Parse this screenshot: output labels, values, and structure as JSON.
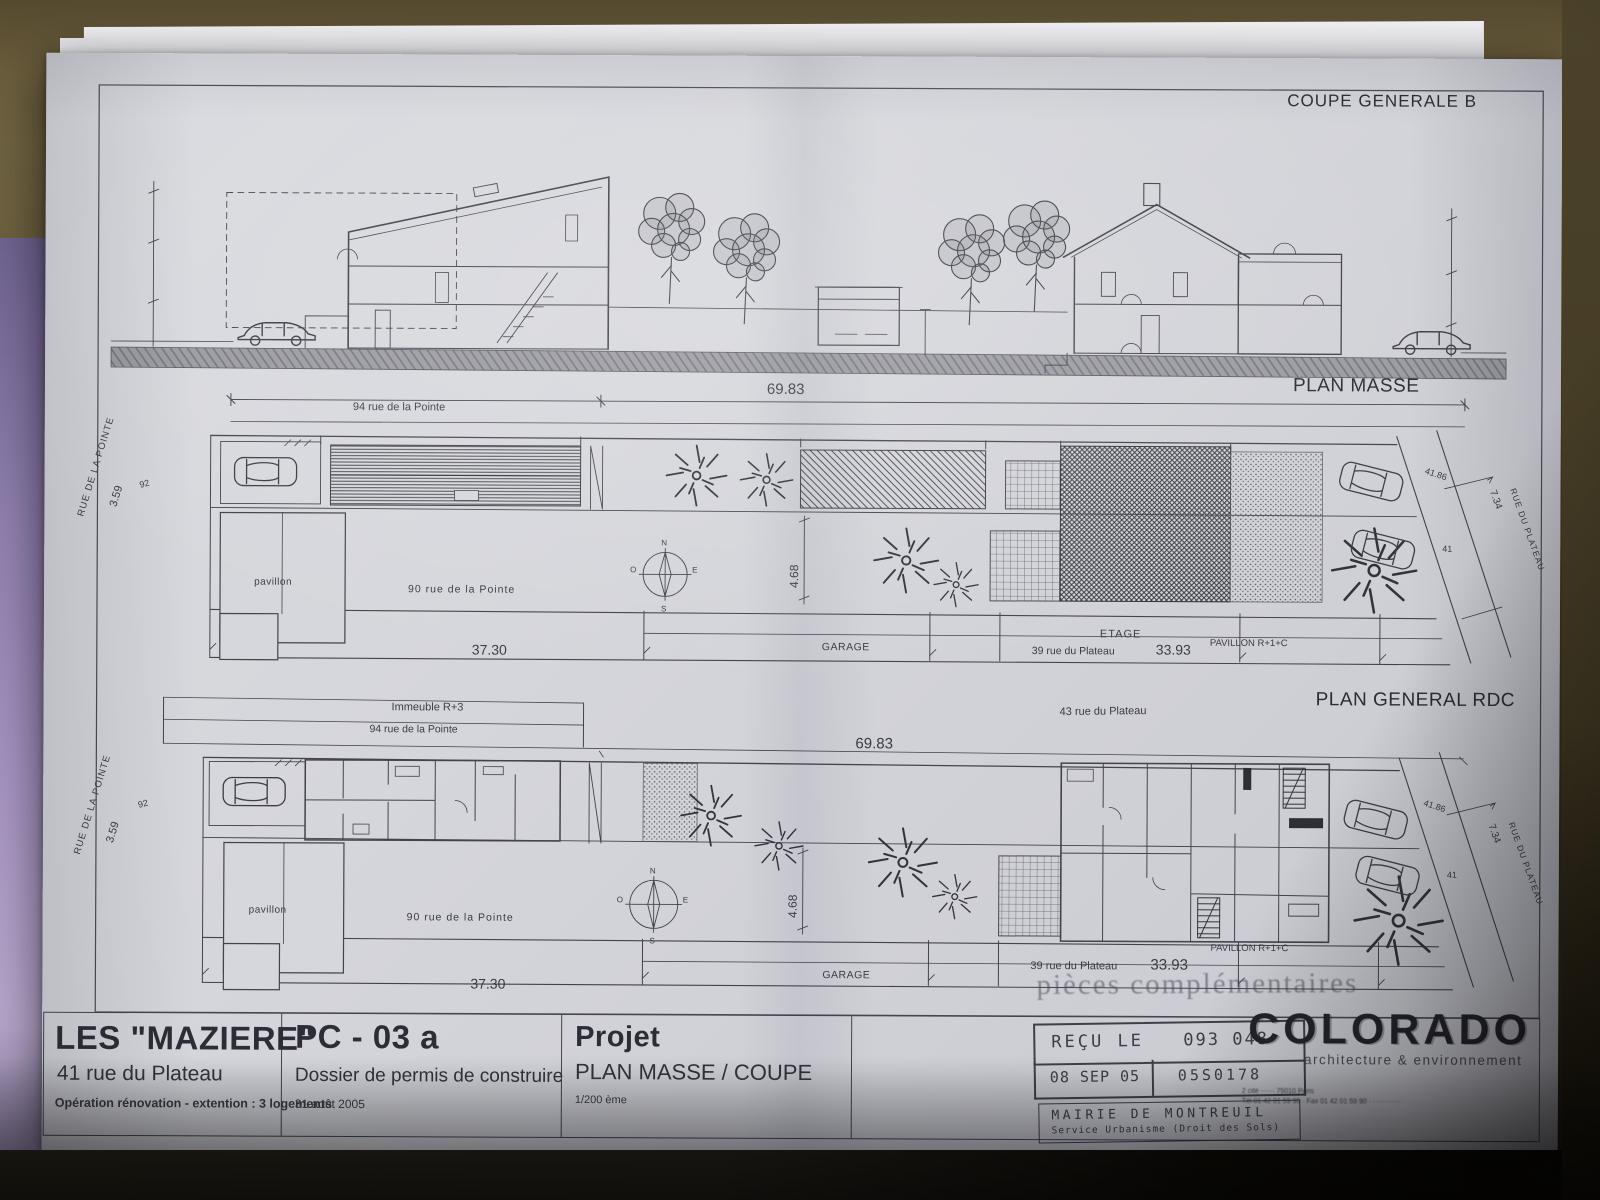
{
  "coupe": {
    "title": "COUPE GENERALE B"
  },
  "masse": {
    "title": "PLAN MASSE",
    "dim_total": "69.83",
    "rue_pointe_94": "94 rue de la Pointe",
    "rue_de_la_pointe": "RUE DE LA POINTE",
    "dim_359": "3.59",
    "dim_92": "92",
    "pavillon": "pavillon",
    "rue_pointe_90": "90 rue de la Pointe",
    "dim_3730": "37.30",
    "garage": "GARAGE",
    "etage": "ETAGE",
    "rue_plateau_39": "39 rue du Plateau",
    "dim_3393": "33.93",
    "pavillon_r1c": "PAVILLON R+1+C",
    "dim_468": "4.68",
    "dim_4186": "41.86",
    "dim_734": "7.34",
    "rue_du_plateau": "RUE DU PLATEAU",
    "dim_41": "41",
    "compass": {
      "n": "N",
      "s": "S",
      "e": "E",
      "o": "O"
    }
  },
  "rdc": {
    "title": "PLAN GENERAL RDC",
    "immeuble": "Immeuble R+3",
    "rue_pointe_94": "94 rue de la Pointe",
    "dim_total": "69.83",
    "rue_plateau_43": "43 rue du Plateau",
    "rue_de_la_pointe": "RUE DE LA POINTE",
    "dim_359": "3.59",
    "dim_92": "92",
    "pavillon": "pavillon",
    "rue_pointe_90": "90 rue de la Pointe",
    "dim_3730": "37.30",
    "garage": "GARAGE",
    "rue_plateau_39": "39 rue du Plateau",
    "dim_3393": "33.93",
    "pavillon_r1c": "PAVILLON R+1+C",
    "dim_468": "4.68",
    "dim_4186": "41.86",
    "dim_734": "7.34",
    "rue_du_plateau": "RUE DU PLATEAU",
    "dim_41": "41",
    "compass": {
      "n": "N",
      "s": "S",
      "e": "E",
      "o": "O"
    }
  },
  "watermark": "pièces complémentaires",
  "titleblock": {
    "name": "LES \"MAZIERE\"",
    "address": "41 rue du Plateau",
    "operation": "Opération rénovation - extention : 3 logements",
    "ref": "PC - 03 a",
    "dossier": "Dossier de permis de construire",
    "date": "31 août 2005",
    "projet": "Projet",
    "sheet": "PLAN MASSE / COUPE",
    "scale": "1/200 ème"
  },
  "stamp": {
    "recu": "REÇU LE",
    "code": "093 048",
    "date": "08 SEP 05",
    "ref": "05S0178",
    "mairie": "MAIRIE DE MONTREUIL",
    "service": "Service Urbanisme (Droit des Sols)"
  },
  "logo": {
    "name": "COLORADO",
    "tagline": "architecture & environnement",
    "address": "2 cité ······ 75010 Paris",
    "contact": "Tél 01 42 01 59 90 · Fax 01 42 01 59 90 · ············"
  }
}
